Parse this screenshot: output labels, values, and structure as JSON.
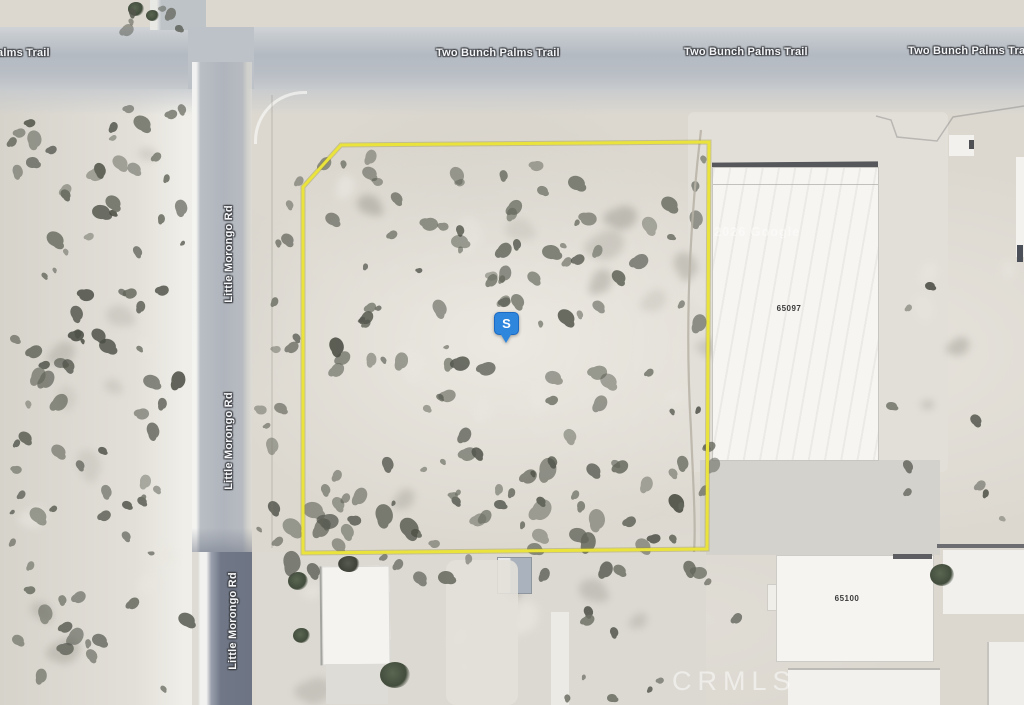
{
  "map": {
    "roads": {
      "two_bunch_palms_trail": "Two Bunch Palms Trail",
      "little_morongo_rd": "Little Morongo Rd"
    },
    "marker": {
      "label": "S"
    },
    "buildings": {
      "number_1": "65097",
      "number_2": "65100"
    },
    "watermarks": {
      "imagery": "2026 Google",
      "mls": "CRMLS"
    },
    "colors": {
      "parcel_outline": "#eae33c",
      "marker_blue": "#2f86dd"
    }
  }
}
